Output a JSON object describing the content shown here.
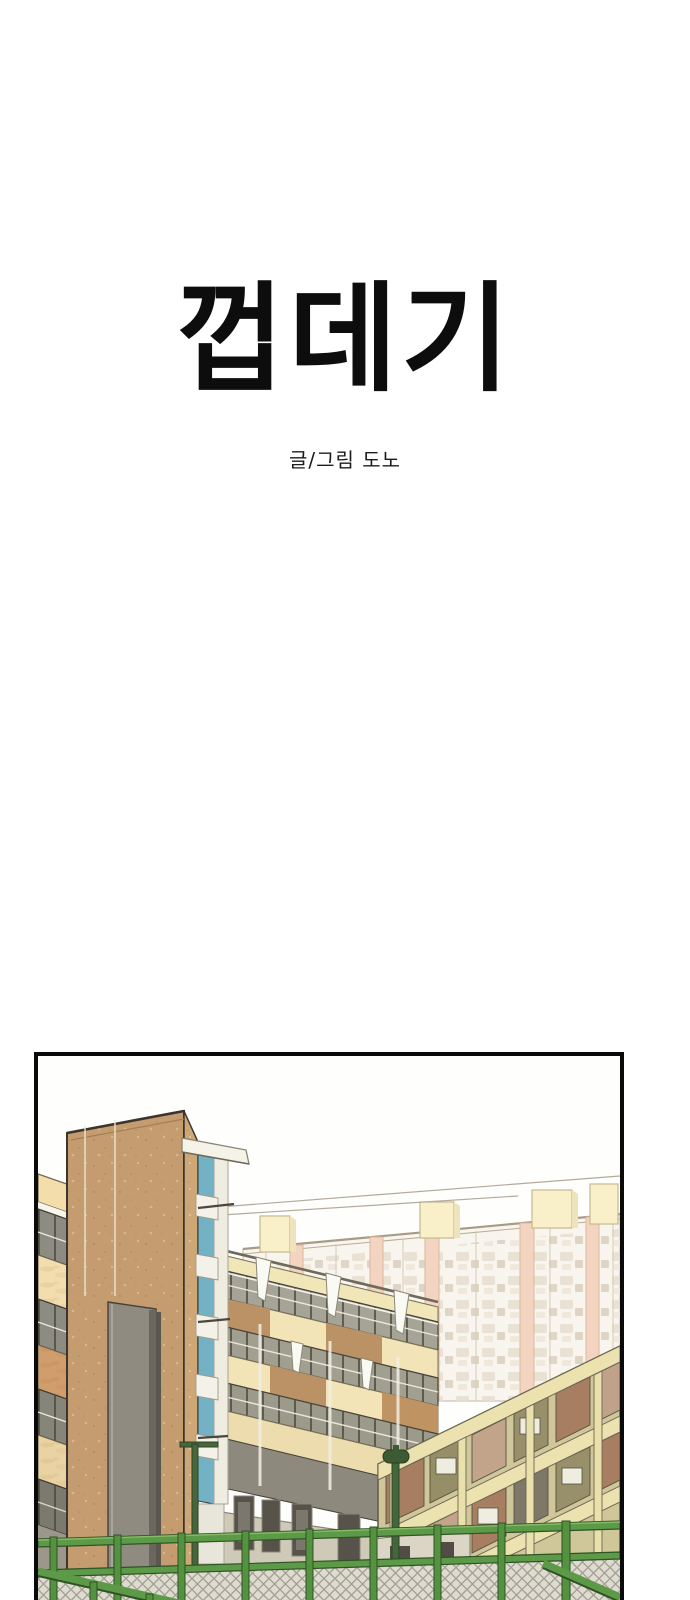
{
  "page": {
    "background": "#ffffff",
    "title": "껍데기",
    "byline": "글/그림 도노"
  },
  "panel": {
    "border_color": "#0a0a0a",
    "content": "school courtyard seen through a green chain-link fence",
    "palette": {
      "ink_outline": "#3b352d",
      "tower_brown": "#c49c6f",
      "tower_side_brown": "#cda876",
      "teal_glass": "#72b2c4",
      "cream_band": "#f1e4b6",
      "peach_spandrel": "#f2ddae",
      "tan_spandrel": "#cf9e6c",
      "window_glass_gray": "#8d8c82",
      "wing_glass": "#a6a496",
      "green_building_wall": "#cfc79a",
      "green_building_band": "#ebe2af",
      "apartment_pale": "#f8f5ee",
      "apartment_pink_stripe": "#f2d4c1",
      "apartment_roofbox_yellow": "#f9f0ca",
      "concrete_gray": "#908b81",
      "fence_green": "#5c9a47",
      "fence_dark_green": "#2f5226",
      "lamp_green": "#3c5a34",
      "mesh_gray": "#dedbd0"
    }
  }
}
